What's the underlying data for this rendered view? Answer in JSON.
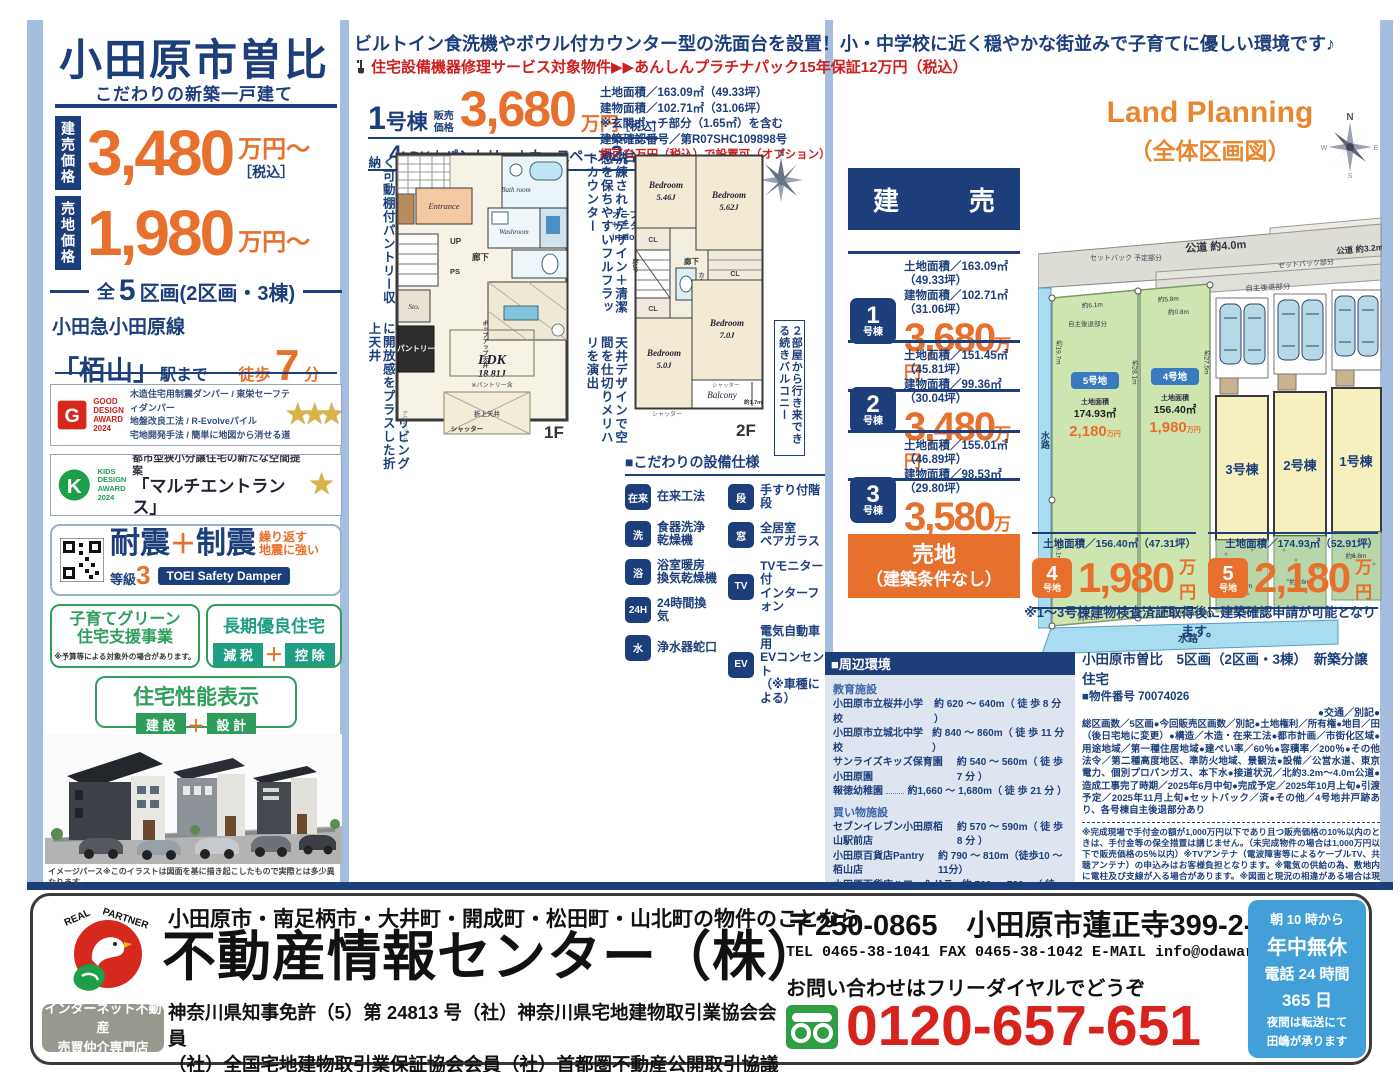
{
  "colors": {
    "navy": "#1c3f7c",
    "orange": "#e8702d",
    "red": "#cc2020",
    "accent_bar": "#a5bddf",
    "sky": "#42a0d8",
    "green": "#2f9e5b"
  },
  "sidebar": {
    "title": "小田原市曽比",
    "subtitle": "こだわりの新築一戸建て",
    "price1": {
      "tag": "建売価格",
      "value": "3,480",
      "unit": "万円〜",
      "tax": "［税込］"
    },
    "price2": {
      "tag": "売地価格",
      "value": "1,980",
      "unit": "万円〜"
    },
    "lots": {
      "pre": "全",
      "num": "5",
      "post": "区画(2区画・3棟)"
    },
    "rail": "小田急小田原線",
    "station": "「栢山」",
    "station_suffix": "駅まで",
    "walk": {
      "label": "徒歩",
      "num": "7",
      "unit": "分"
    },
    "good_design": {
      "award": "GOOD\nDESIGN\nAWARD\n2024",
      "line1": "木造住宅用制震ダンパー / 東栄セーフティダンパー",
      "line2": "地盤改良工法 / R-Evolveパイル",
      "line3": "宅地開発手法 / 簡単に地図から消せる道",
      "stars": "★★★"
    },
    "kids_design": {
      "award": "KIDS\nDESIGN\nAWARD\n2024",
      "line1": "都市型狭小分譲住宅の新たな空間提案",
      "line2": "「マルチエントランス」",
      "stars": "★"
    },
    "taishin": {
      "word1": "耐震",
      "grade": "等級",
      "grade_num": "3",
      "plus": "＋",
      "word2": "制震",
      "sub": "繰り返す\n地震に強い",
      "badge": "TOEI Safety Damper"
    },
    "kosodate": {
      "line1": "子育てグリーン",
      "line2": "住宅支援事業",
      "note": "※予算等による対象外の場合があります。"
    },
    "choki": {
      "title": "長期優良住宅",
      "tag1": "減 税",
      "plus": "＋",
      "tag2": "控 除"
    },
    "seinou": {
      "title": "住宅性能表示",
      "tag1": "建 設",
      "plus": "＋",
      "tag2": "設 計"
    },
    "render_caption": "イメージパース※このイラストは図面を基に描き起こしたもので実際とは多少異なります。"
  },
  "header": {
    "line1": "ビルトイン食洗機やボウル付カウンター型の洗面台を設置！小・中学校に近く穏やかな街並みで子育てに優しい環境です♪",
    "line2": "住宅設備機器修理サービス対象物件▶▶あんしんプラチナパック15年保証12万円（税込）"
  },
  "unit1": {
    "name_num": "1",
    "name_suffix": "号棟",
    "price_label": "販売\n価格",
    "price": "3,680",
    "unit": "万円",
    "tax": "［税込］",
    "layout_a": "4",
    "layout_b": "LDK＋パントリー＋カースペース",
    "layout_c": "2",
    "layout_d": "台",
    "d1": "土地面積／163.09㎡（49.33坪）",
    "d2": "建物面積／102.71㎡（31.06坪）",
    "d3": "※玄関ポーチ部分（1.65㎡）を含む",
    "d4": "建築確認番号／第R07SHC109898号",
    "d5": "網戸11万円（税込）で設置可（オプション）"
  },
  "annotations": {
    "a1": "キッチンがスッキリ片付く可動棚付パントリー収納",
    "a2": "天井を高くしてリビングに開放感をプラスした折上天井",
    "a3": "洗練されたデザイン＋清潔感を保ちやすいフルフラットカウンター",
    "a4": "天井デザインで空間を仕切りメリハリを演出",
    "a5": "２部屋から行き来できる続きバルコニー",
    "sanitary": "オープン\nサニタリー\nirodori"
  },
  "floorplan1": {
    "label": "1F",
    "ldk": "LDK",
    "ldk_size": "18.81J",
    "ldk_note": "※パントリー含",
    "entrance": "Entrance",
    "bath": "Bath\nroom",
    "wash": "Washroom",
    "hall": "廊下",
    "up": "UP",
    "ps": "PS",
    "sto": "Sto.",
    "pantry": "パントリー",
    "oriage": "折上天井",
    "popup": "ポップアップ天井",
    "shutter": "シャッター",
    "accent": "アクセントクロス"
  },
  "floorplan2": {
    "label": "2F",
    "bed1": "Bedroom",
    "bed1_size": "5.46J",
    "bed2": "Bedroom",
    "bed2_size": "5.62J",
    "bed3": "Bedroom",
    "bed3_size": "7.0J",
    "bed4": "Bedroom",
    "bed4_size": "5.0J",
    "balcony": "Balcony",
    "balcony_m": "約1.7m",
    "cl": "CL",
    "hall": "廊下",
    "dn": "DN",
    "yukaup": "床UP",
    "counter": "カウンター",
    "shutter": "シャッター"
  },
  "equipment": {
    "title": "■こだわりの設備仕様",
    "items": [
      {
        "icon": "conventional-construction-icon",
        "glyph": "在来",
        "label": "在来工法"
      },
      {
        "icon": "dishwasher-icon",
        "glyph": "洗",
        "label": "食器洗浄\n乾燥機"
      },
      {
        "icon": "bathroom-dryer-icon",
        "glyph": "浴",
        "label": "浴室暖房\n換気乾燥機"
      },
      {
        "icon": "ventilation-icon",
        "glyph": "24H",
        "label": "24時間換気"
      },
      {
        "icon": "water-purifier-icon",
        "glyph": "水",
        "label": "浄水器蛇口"
      },
      {
        "icon": "handrail-stairs-icon",
        "glyph": "段",
        "label": "手すり付階段"
      },
      {
        "icon": "pair-glass-icon",
        "glyph": "窓",
        "label": "全居室\nペアガラス"
      },
      {
        "icon": "tv-interphone-icon",
        "glyph": "TV",
        "label": "TVモニター付\nインターフォン"
      },
      {
        "icon": "ev-outlet-icon",
        "glyph": "EV",
        "label": "電気自動車用\nEVコンセント\n（※車種による）"
      }
    ]
  },
  "tateuri": {
    "header": "建　売",
    "rows": [
      {
        "num": "1",
        "suffix": "号棟",
        "land": "土地面積／163.09㎡（49.33坪）",
        "bldg": "建物面積／102.71㎡（31.06坪）",
        "price": "3,680",
        "unit": "万円"
      },
      {
        "num": "2",
        "suffix": "号棟",
        "land": "土地面積／151.45㎡（45.81坪）",
        "bldg": "建物面積／99.36㎡（30.04坪）",
        "price": "3,480",
        "unit": "万円"
      },
      {
        "num": "3",
        "suffix": "号棟",
        "land": "土地面積／155.01㎡（46.89坪）",
        "bldg": "建物面積／98.53㎡（29.80坪）",
        "price": "3,580",
        "unit": "万円"
      }
    ]
  },
  "land_planning": {
    "title": "Land Planning",
    "subtitle": "（全体区画図）"
  },
  "map": {
    "road_top": "公道\n約4.0m",
    "road_right": "公道\n約3.2m",
    "setback_left": "セットバック\n予定部分",
    "setback_right": "セットバック部分",
    "jishu_strip": "自主後退部分",
    "jishu_plot": "自主後退\n部分",
    "water_left": "水路",
    "water_bottom": "水路",
    "m197": "約19.7m",
    "m281": "約28.1m",
    "m275": "約27.5m",
    "m91": "約9.1m",
    "m61a": "約6.1m",
    "m58a": "約5.8m",
    "m08": "約0.8m",
    "m61b": "約6.1m",
    "m58b": "約5.8m",
    "m72": "約7.2m",
    "m66": "約6.6m",
    "m68": "約6.8m",
    "lot5": {
      "badge": "5号地",
      "area_label": "土地面積",
      "area": "174.93㎡",
      "price": "2,180",
      "unit": "万円"
    },
    "lot4": {
      "badge": "4号地",
      "area_label": "土地面積",
      "area": "156.40㎡",
      "price": "1,980",
      "unit": "万円"
    },
    "b3": "3号棟",
    "b2": "2号棟",
    "b1": "1号棟",
    "compass": {
      "n": "N",
      "e": "E",
      "w": "W",
      "s": "S"
    }
  },
  "urichi": {
    "box1": "売地",
    "box2": "（建築条件なし）",
    "lots": [
      {
        "num": "4",
        "suffix": "号地",
        "land": "土地面積／156.40㎡（47.31坪）",
        "price": "1,980",
        "unit": "万円"
      },
      {
        "num": "5",
        "suffix": "号地",
        "land": "土地面積／174.93㎡（52.91坪）",
        "price": "2,180",
        "unit": "万円"
      }
    ],
    "note": "※1〜3号棟建物検査済証取得後に建築確認申請が可能となります。"
  },
  "environment": {
    "title": "■周辺環境",
    "sec1": "教育施設",
    "edu": [
      {
        "name": "小田原市立桜井小学校",
        "dist": "約 620 〜 640m（ 徒 歩 8 分 ）"
      },
      {
        "name": "小田原市立城北中学校",
        "dist": "約 840 〜 860m（ 徒 歩 11 分 ）"
      },
      {
        "name": "サンライズキッズ保育園小田原園",
        "dist": "約 540 〜 560m（ 徒 歩 7 分 ）"
      },
      {
        "name": "報徳幼稚園",
        "dist": "約1,660 〜 1,680m（ 徒 歩 21 分 ）"
      }
    ],
    "sec2": "買い物施設",
    "shop": [
      {
        "name": "セブンイレブン小田原栢山駅前店",
        "dist": "約 570 〜 590m（ 徒 歩 8 分 ）"
      },
      {
        "name": "小田原百貨店Pantry栢山店",
        "dist": "約 790 〜 810m（徒歩10 〜 11分）"
      },
      {
        "name": "小田原百貨店ハロー＆ドラッグ栢山店",
        "dist": "約 760 〜 780m（ 徒 歩 10 分 ）"
      }
    ],
    "sec3": "その他施設",
    "other": [
      {
        "name": "栢山駅前郵便局",
        "dist": "約 530 〜 550m（ 徒 歩 7 分 ）"
      },
      {
        "name": "青木医院",
        "dist": "約 560 〜 580m（徒歩7 〜 8分）"
      },
      {
        "name": "栢山みどりの広場",
        "dist": "約1,110 〜 1,130m（徒歩14 〜 15分）"
      }
    ]
  },
  "property": {
    "title": "小田原市曽比　5区画（2区画・3棟）　新築分譲住宅",
    "number": "■物件番号 70074026",
    "traffic": "●交通／別記●",
    "body": "総区画数／5区画●今回販売区画数／別記●土地権利／所有権●地目／田（後日宅地に変更）●構造／木造・在来工法●都市計画／市街化区域●用途地域／第一種住居地域●建ぺい率／60％●容積率／200％●その他法令／第二種高度地区、準防火地域、景観法●設備／公営水道、東京電力、個別プロパンガス、本下水●接道状況／北約3.2m〜4.0m公道●造成工事完了時期／2025年6月中旬●完成予定／2025年10月上旬●引渡予定／2025年11月上旬●セットバック／済●その他／4号地井戸跡あり、各号棟自主後退部分あり",
    "fine": "※完成現場で手付金の額が1,000万円以下であり且つ販売価格の10％以内のときは、手付金等の保全措置は講じません。（未完成物件の場合は1,000万円以下で販売価格の5％以内）※TVアンテナ（電波障害等によるケーブルTV、共聴アンテナ）の申込みはお客様負担となります。※電気の供給の為、敷地内に電柱及び支線が入る場合があります。※図面と現況の相違がある場合は現況優先にてご了承願います。※司法書士、土地家屋調査士は当社指定とさせていただきます。※電子契約の場合、手数料として5,000円（税込）を頂戴致します。※子育てグリーン住宅支援事業対象の場合、事務手数料として99,000円（税込）を頂戴致します。※網戸は東栄ホームサービスへの発注となります。尚表示価格は建物引渡20日前迄の申込が条件となります。※FIX窓・ドア（玄関・勝手口・テラス）は対象外となります。"
  },
  "footer": {
    "logo_text": "REAL PARTNER",
    "area_line": "小田原市・南足柄市・大井町・開成町・松田町・山北町の物件のことなら",
    "company": "不動産情報センター（株）",
    "badge1": "インターネット不動産",
    "badge2": "売買仲介専門店",
    "license1": "神奈川県知事免許（5）第 24813 号（社）神奈川県宅地建物取引業協会会員",
    "license2": "（社）全国宅地建物取引業保証協会会員（社）首都圏不動産公開取引協議会加盟",
    "address": "〒250-0865　小田原市蓮正寺399-2-10",
    "contact": "TEL 0465-38-1041 FAX 0465-38-1042 E-MAIL info@odawara1.co.jp",
    "inquiry": "お問い合わせはフリーダイヤルでどうぞ",
    "phone": "0120-657-651",
    "hours": {
      "h1": "朝 10 時から",
      "h2": "年中無休",
      "h3": "電話 24 時間",
      "h4": "365 日",
      "h5": "夜間は転送にて",
      "h6": "田嶋が承ります"
    }
  }
}
